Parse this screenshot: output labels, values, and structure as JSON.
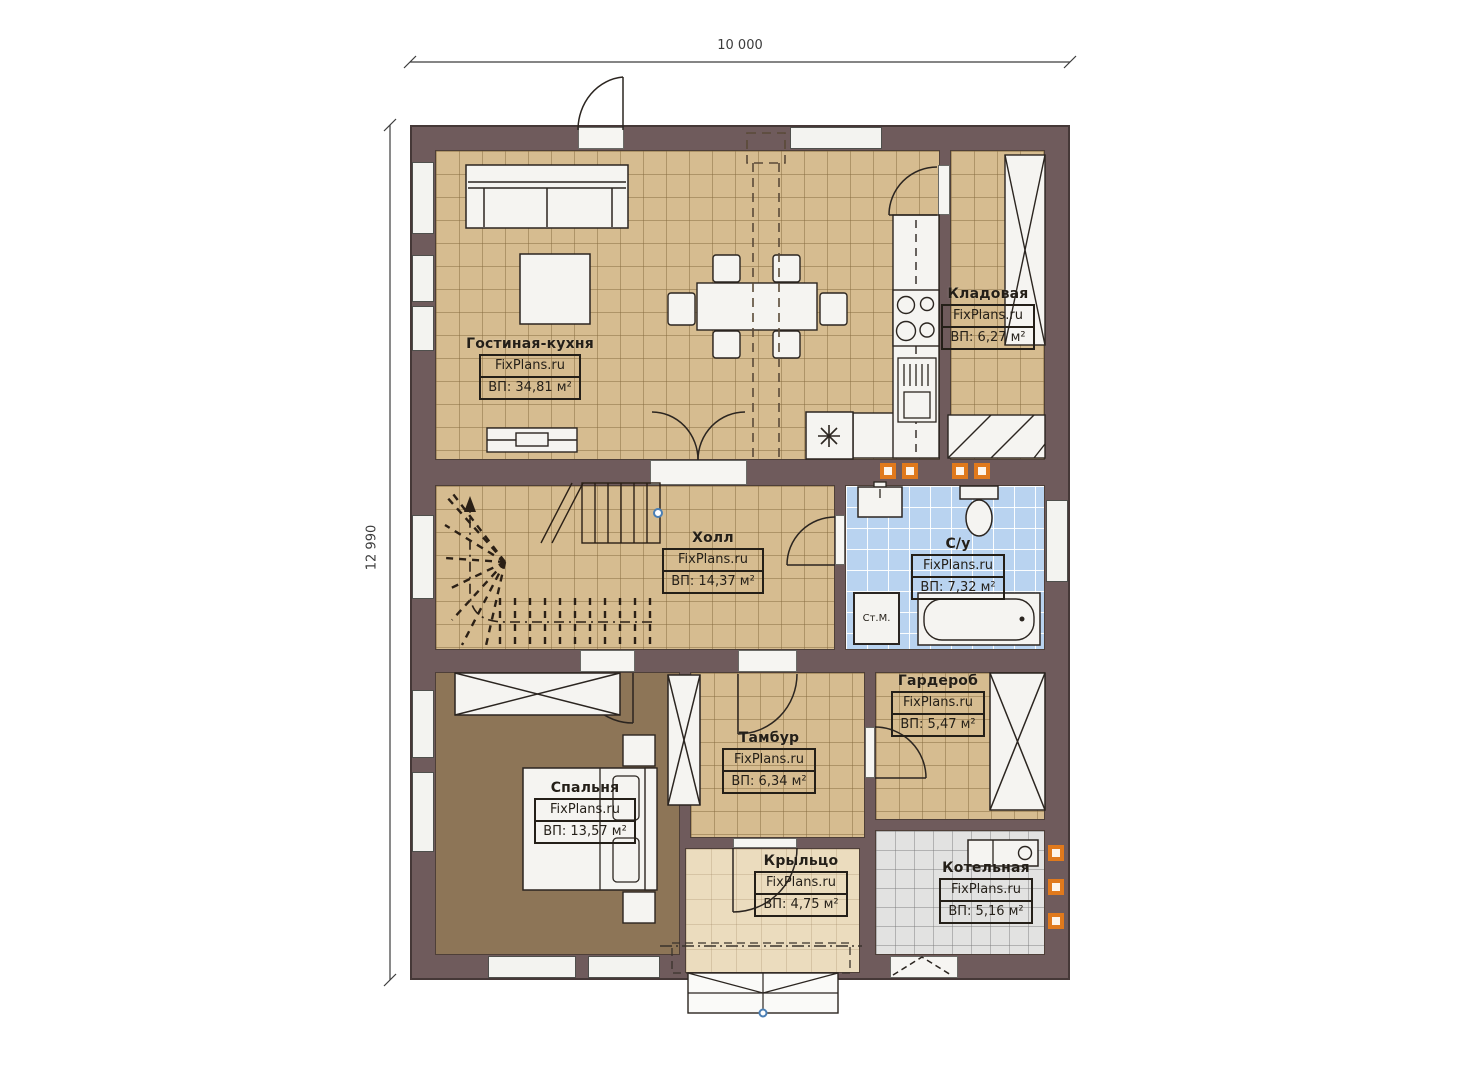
{
  "plan": {
    "dimensions": {
      "width_label": "10 000",
      "height_label": "12 990"
    },
    "brand": "FixPlans.ru",
    "rooms": [
      {
        "name": "Гостиная-кухня",
        "brand": "FixPlans.ru",
        "area": "ВП: 34,81 м²"
      },
      {
        "name": "Кладовая",
        "brand": "FixPlans.ru",
        "area": "ВП: 6,27 м²"
      },
      {
        "name": "Холл",
        "brand": "FixPlans.ru",
        "area": "ВП: 14,37 м²"
      },
      {
        "name": "С/у",
        "brand": "FixPlans.ru",
        "area": "ВП: 7,32 м²"
      },
      {
        "name": "Гардероб",
        "brand": "FixPlans.ru",
        "area": "ВП: 5,47 м²"
      },
      {
        "name": "Тамбур",
        "brand": "FixPlans.ru",
        "area": "ВП: 6,34 м²"
      },
      {
        "name": "Спальня",
        "brand": "FixPlans.ru",
        "area": "ВП: 13,57 м²"
      },
      {
        "name": "Крыльцо",
        "brand": "FixPlans.ru",
        "area": "ВП: 4,75 м²"
      },
      {
        "name": "Котельная",
        "brand": "FixPlans.ru",
        "area": "ВП: 5,16 м²"
      }
    ],
    "appliances": {
      "washing_machine": "Ст.М."
    },
    "colors": {
      "wall": "#6f5b5c",
      "floor_beige": "#d6bc90",
      "floor_blue": "#b9d3f0",
      "floor_brown": "#8d7557",
      "floor_cream": "#ebdcbe",
      "floor_gray": "#e2e2e1",
      "vent_orange": "#e0791c"
    }
  }
}
